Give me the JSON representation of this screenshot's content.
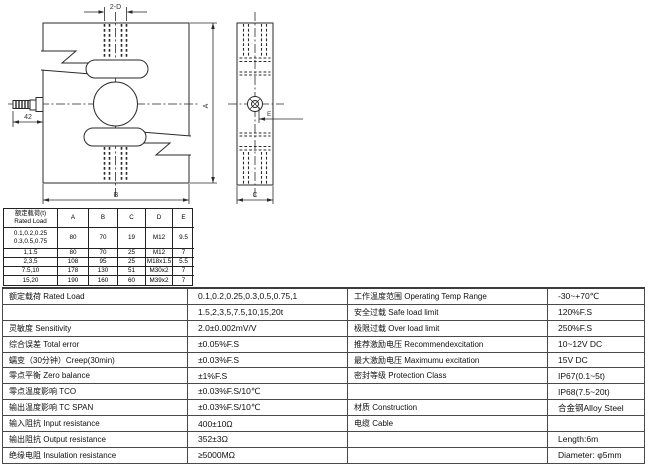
{
  "drawing": {
    "front_view": {
      "top_thread_dim": "2-D",
      "cable_dim": "42",
      "height_dim": "A",
      "width_dim": "B"
    },
    "side_view": {
      "step_dim": "E",
      "depth_dim": "C"
    }
  },
  "dimension_table": {
    "header": {
      "load_label_zh": "额定载荷(t)",
      "load_label_en": "Rated Load",
      "columns": [
        "A",
        "B",
        "C",
        "D",
        "E"
      ]
    },
    "rows": [
      {
        "load": "0.1,0.2,0.25",
        "load2": "0.3,0.5,0.75",
        "a": "80",
        "b": "70",
        "c": "19",
        "d": "M12",
        "e": "9.5"
      },
      {
        "load": "1,1.5",
        "a": "80",
        "b": "70",
        "c": "25",
        "d": "M12",
        "e": "7"
      },
      {
        "load": "2,3,5",
        "a": "108",
        "b": "95",
        "c": "25",
        "d": "M18x1.5",
        "e": "5.5"
      },
      {
        "load": "7.5,10",
        "a": "178",
        "b": "130",
        "c": "51",
        "d": "M30x2",
        "e": "7"
      },
      {
        "load": "15,20",
        "a": "190",
        "b": "160",
        "c": "60",
        "d": "M39x2",
        "e": "7"
      }
    ]
  },
  "spec_table": {
    "left": [
      {
        "label": "额定载荷 Rated Load",
        "value": "0.1,0.2,0.25,0.3,0.5,0.75,1"
      },
      {
        "label": "",
        "value": "1.5,2,3,5,7.5,10,15,20t"
      },
      {
        "label": "灵敏度 Sensitivity",
        "value": "2.0±0.002mV/V"
      },
      {
        "label": "综合误差 Total error",
        "value": "±0.05%F.S"
      },
      {
        "label": "蠕变（30分钟）Creep(30min)",
        "value": "±0.03%F.S"
      },
      {
        "label": "零点平衡 Zero balance",
        "value": "±1%F.S"
      },
      {
        "label": "零点温度影响 TCO",
        "value": "±0.03%F.S/10℃"
      },
      {
        "label": "输出温度影响 TC SPAN",
        "value": "±0.03%F.S/10℃"
      },
      {
        "label": "输入阻抗 Input resistance",
        "value": "400±10Ω"
      },
      {
        "label": "输出阻抗 Output resistance",
        "value": "352±3Ω"
      },
      {
        "label": "绝缘电阻 Insulation resistance",
        "value": "≥5000MΩ"
      }
    ],
    "right": [
      {
        "label": "工作温度范围 Operating Temp Range",
        "value": "-30~+70℃"
      },
      {
        "label": "安全过载 Safe load limit",
        "value": "120%F.S"
      },
      {
        "label": "极限过载 Over load limit",
        "value": "250%F.S"
      },
      {
        "label": "推荐激励电压 Recommendexcitation",
        "value": "10~12V DC"
      },
      {
        "label": "最大激励电压 Maximumu excitation",
        "value": "15V DC"
      },
      {
        "label": "密封等级 Protection Class",
        "value": "IP67(0.1~5t)"
      },
      {
        "label": "",
        "value": "IP68(7.5~20t)"
      },
      {
        "label": "材质 Construction",
        "value": "合金钢Alloy Steel"
      },
      {
        "label": "电缆 Cable",
        "value": ""
      },
      {
        "label": "",
        "value": "Length:6m"
      },
      {
        "label": "",
        "value": "Diameter: φ5mm"
      }
    ]
  }
}
